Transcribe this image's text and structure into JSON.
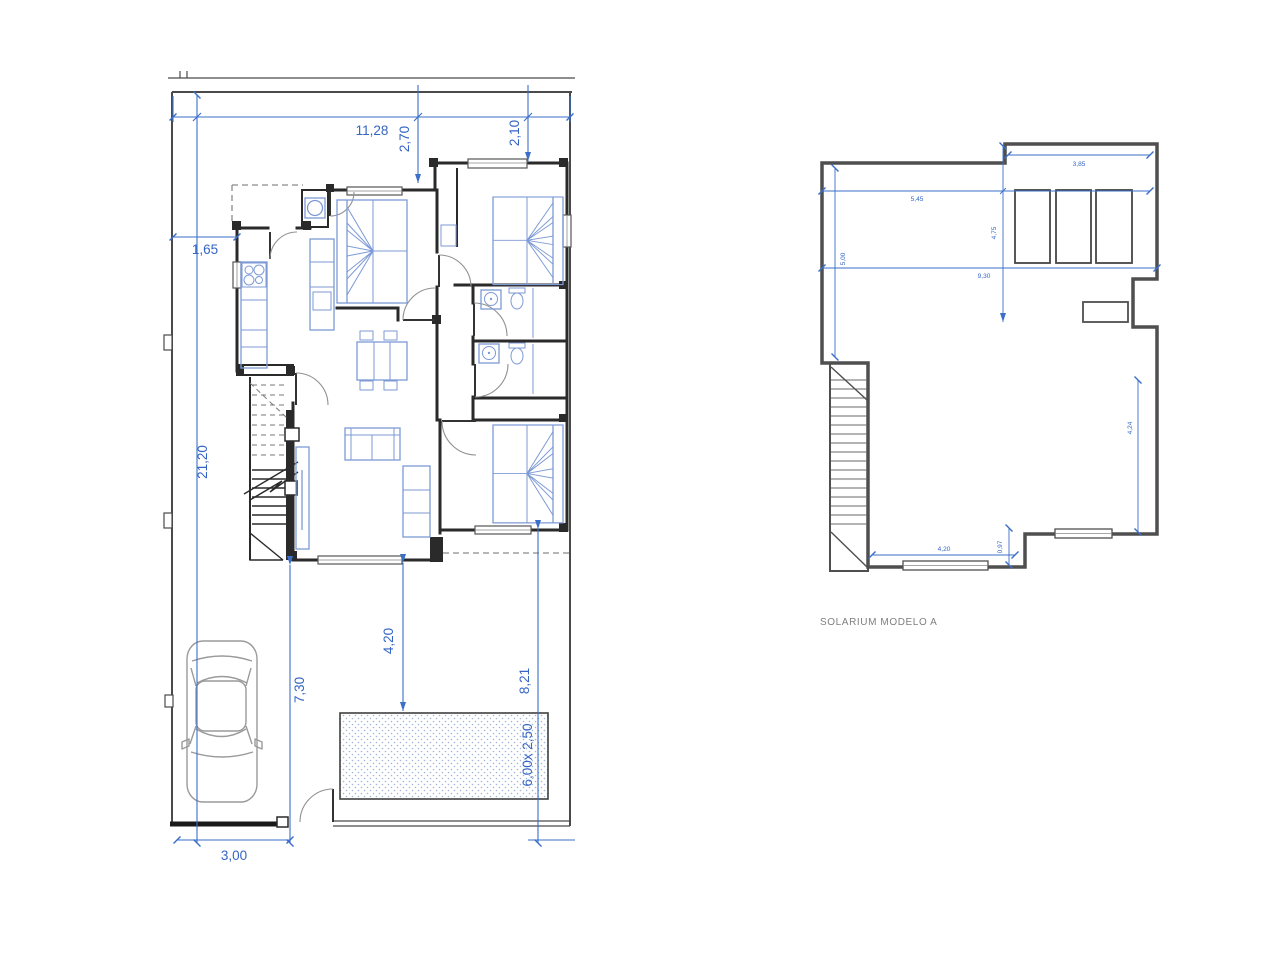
{
  "page": {
    "background": "#ffffff"
  },
  "colors": {
    "dimension_blue": "#3565c4",
    "dimension_line_blue": "#3b6fc9",
    "furniture_blue": "#7d9ad6",
    "wall_dark": "#2a2a2a",
    "solarium_wall_gray": "#4f4f4f",
    "tile_gray": "#b8b8b8",
    "pool_dot_blue": "#9fb6d9",
    "car_gray": "#9a9a9a",
    "caption_gray": "#7f7f7f"
  },
  "site_plan": {
    "dimensions": {
      "plot_width_top": "11,28",
      "front_setback_left": "2,70",
      "front_setback_right": "2,10",
      "side_setback_left": "1,65",
      "plot_depth": "21,20",
      "rear_garden_left": "7,30",
      "rear_garden_center": "4,20",
      "rear_garden_right": "8,21",
      "gate_width": "3,00",
      "pool_size": "6,00x 2,50"
    }
  },
  "solarium_plan": {
    "caption": "SOLARIUM MODELO A",
    "dimensions": {
      "top_right_width": "3,85",
      "top_left_width": "5,45",
      "left_height": "5,00",
      "middle_width": "9,30",
      "middle_height": "4,75",
      "bottom_width": "4,20",
      "step_height": "0,97",
      "right_height": "4,24"
    }
  }
}
